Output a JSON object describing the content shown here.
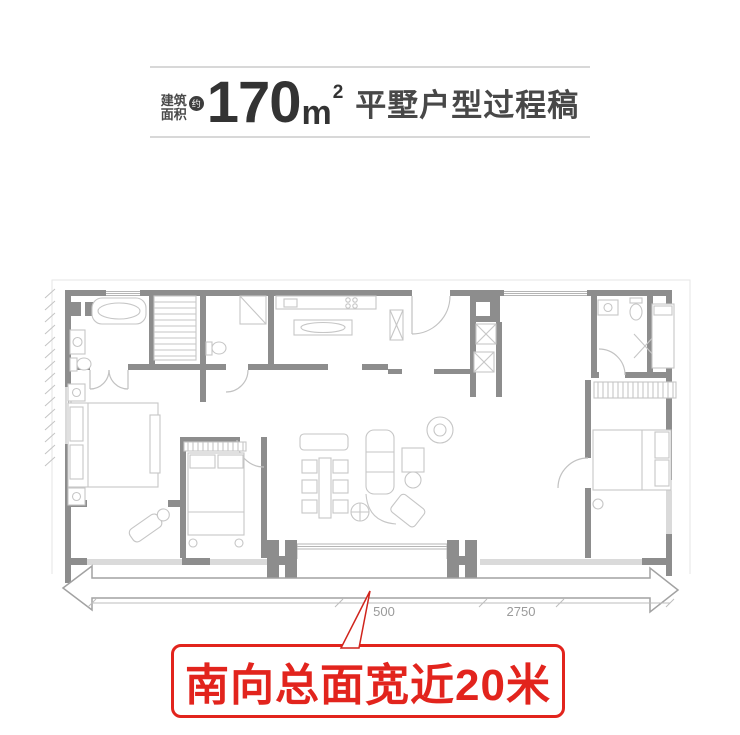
{
  "title": {
    "label_line1": "建筑",
    "label_line2": "面积",
    "approx": "约",
    "area_value": "170",
    "area_unit": "m",
    "area_sup": "2",
    "suffix": "平墅户型过程稿"
  },
  "plan": {
    "dims": [
      "500",
      "2750"
    ]
  },
  "callout": {
    "text": "南向总面宽近20米"
  },
  "colors": {
    "accent_red": "#e2241d",
    "wall_gray": "#8d8d8d",
    "furniture_line": "#c6c6c6",
    "dim_text": "#9a9a9a",
    "title_text": "#333333",
    "rule_gray": "#d8d8d8"
  }
}
